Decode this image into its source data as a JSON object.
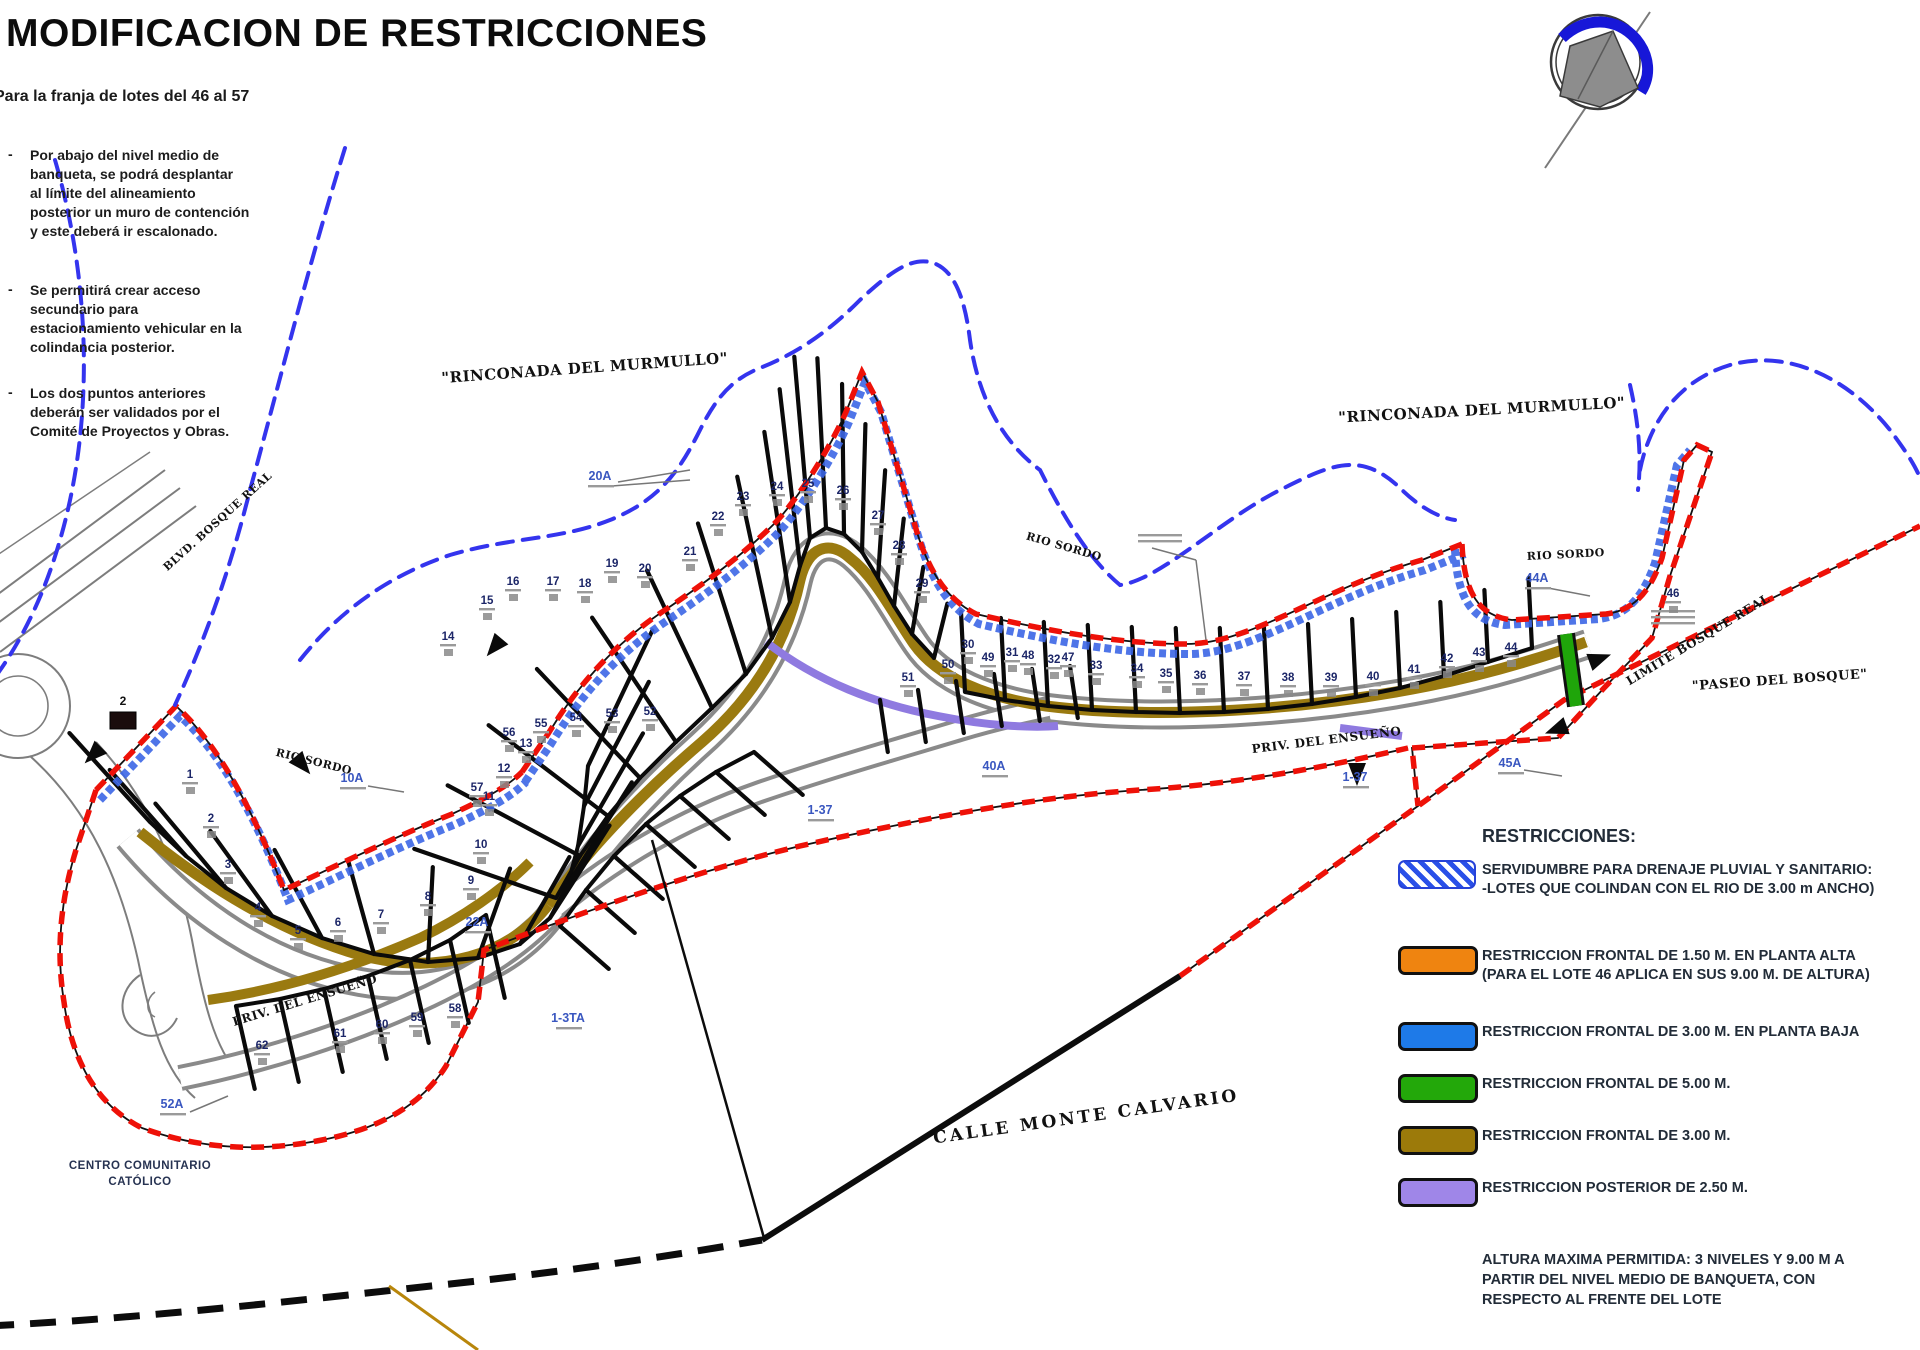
{
  "title": "MODIFICACION DE RESTRICCIONES",
  "subtitle": "Para la franja de lotes del 46 al 57",
  "bullets": [
    {
      "text": "Por abajo del nivel medio de\nbanqueta, se podrá desplantar\nal límite del alineamiento\nposterior un muro de contención\ny este deberá ir escalonado."
    },
    {
      "text": "Se permitirá crear acceso\nsecundario para\nestacionamiento vehicular en la\ncolindancia posterior."
    },
    {
      "text": "Los dos puntos anteriores\ndeberán ser validados por el\nComité de Proyectos y Obras."
    }
  ],
  "legend": {
    "heading": "RESTRICCIONES:",
    "items": [
      {
        "swatch": "hatch-blue",
        "color": "#2a50e8",
        "text": "SERVIDUMBRE PARA DRENAJE PLUVIAL Y SANITARIO:\n-LOTES QUE COLINDAN CON EL RIO DE 3.00 m ANCHO)"
      },
      {
        "swatch": "orange",
        "color": "#ef8410",
        "text": "RESTRICCION FRONTAL DE 1.50 M. EN PLANTA ALTA\n(PARA EL LOTE 46 APLICA EN SUS 9.00 M. DE ALTURA)"
      },
      {
        "swatch": "blue",
        "color": "#1e7ae8",
        "text": "RESTRICCION FRONTAL DE 3.00 M. EN PLANTA BAJA"
      },
      {
        "swatch": "green",
        "color": "#23a80a",
        "text": "RESTRICCION FRONTAL DE 5.00 M."
      },
      {
        "swatch": "olive",
        "color": "#9c7a0a",
        "text": "RESTRICCION FRONTAL DE 3.00 M."
      },
      {
        "swatch": "purple",
        "color": "#9f86e8",
        "text": "RESTRICCION POSTERIOR DE 2.50 M."
      }
    ],
    "note": "ALTURA MAXIMA PERMITIDA: 3 NIVELES Y 9.00 M A\nPARTIR DEL NIVEL MEDIO DE BANQUETA, CON\nRESPECTO AL FRENTE DEL LOTE"
  },
  "footer": {
    "centro": "CENTRO COMUNITARIO\nCATÓLICO"
  },
  "map": {
    "colors": {
      "boundary_red": "#ee1108",
      "easement_blue": "#3b66e6",
      "boundary_dashed_blue": "#3434ee",
      "frontal_olive": "#9a7a10",
      "frontal_green": "#1fa50a",
      "posterior_purple": "#8f7ae0",
      "north_arrow_blue": "#1717d8"
    },
    "north_arrow": {
      "name": "compass-north-arrow"
    },
    "street_labels": [
      {
        "text": "\"RINCONADA DEL MURMULLO\"",
        "x": 585,
        "y": 373,
        "rot": -4,
        "size": 15
      },
      {
        "text": "\"RINCONADA DEL MURMULLO\"",
        "x": 1482,
        "y": 415,
        "rot": -3,
        "size": 15
      },
      {
        "text": "RIO SORDO",
        "x": 313,
        "y": 765,
        "rot": 14,
        "size": 11
      },
      {
        "text": "RIO SORDO",
        "x": 1063,
        "y": 550,
        "rot": 16,
        "size": 11
      },
      {
        "text": "RIO SORDO",
        "x": 1566,
        "y": 558,
        "rot": -3,
        "size": 11
      },
      {
        "text": "CALLE MONTE CALVARIO",
        "x": 1087,
        "y": 1122,
        "rot": -8,
        "size": 17
      },
      {
        "text": "PRIV. DEL ENSUEÑO",
        "x": 1327,
        "y": 744,
        "rot": -7,
        "size": 12
      },
      {
        "text": "PRIV. DEL ENSUEÑO",
        "x": 306,
        "y": 1004,
        "rot": -17,
        "size": 12
      },
      {
        "text": "LIMITE BOSQUE REAL",
        "x": 1700,
        "y": 643,
        "rot": -31,
        "size": 12
      },
      {
        "text": "\"PASEO DEL BOSQUE\"",
        "x": 1780,
        "y": 684,
        "rot": -4,
        "size": 13
      },
      {
        "text": "BLVD. BOSQUE REAL",
        "x": 220,
        "y": 524,
        "rot": -42,
        "size": 11
      }
    ],
    "special_labels": [
      {
        "text": "20A",
        "x": 600,
        "y": 480
      },
      {
        "text": "10A",
        "x": 352,
        "y": 782
      },
      {
        "text": "22A",
        "x": 477,
        "y": 926
      },
      {
        "text": "40A",
        "x": 994,
        "y": 770
      },
      {
        "text": "44A",
        "x": 1537,
        "y": 582
      },
      {
        "text": "45A",
        "x": 1510,
        "y": 767
      },
      {
        "text": "52A",
        "x": 172,
        "y": 1108
      },
      {
        "text": "1-37",
        "x": 1355,
        "y": 781
      },
      {
        "text": "1-37",
        "x": 820,
        "y": 814
      },
      {
        "text": "1-3TA",
        "x": 568,
        "y": 1022
      }
    ],
    "boxed_label": {
      "text": "2",
      "x": 124,
      "y": 706
    },
    "lot_numbers": [
      {
        "n": "1",
        "x": 190,
        "y": 778
      },
      {
        "n": "2",
        "x": 211,
        "y": 822
      },
      {
        "n": "3",
        "x": 228,
        "y": 868
      },
      {
        "n": "4",
        "x": 258,
        "y": 911
      },
      {
        "n": "5",
        "x": 298,
        "y": 934
      },
      {
        "n": "6",
        "x": 338,
        "y": 926
      },
      {
        "n": "7",
        "x": 381,
        "y": 918
      },
      {
        "n": "8",
        "x": 428,
        "y": 900
      },
      {
        "n": "9",
        "x": 471,
        "y": 884
      },
      {
        "n": "10",
        "x": 481,
        "y": 848
      },
      {
        "n": "11",
        "x": 489,
        "y": 800
      },
      {
        "n": "12",
        "x": 504,
        "y": 772
      },
      {
        "n": "13",
        "x": 526,
        "y": 747
      },
      {
        "n": "14",
        "x": 448,
        "y": 640
      },
      {
        "n": "15",
        "x": 487,
        "y": 604
      },
      {
        "n": "16",
        "x": 513,
        "y": 585
      },
      {
        "n": "17",
        "x": 553,
        "y": 585
      },
      {
        "n": "18",
        "x": 585,
        "y": 587
      },
      {
        "n": "19",
        "x": 612,
        "y": 567
      },
      {
        "n": "20",
        "x": 645,
        "y": 572
      },
      {
        "n": "21",
        "x": 690,
        "y": 555
      },
      {
        "n": "22",
        "x": 718,
        "y": 520
      },
      {
        "n": "23",
        "x": 743,
        "y": 500
      },
      {
        "n": "24",
        "x": 777,
        "y": 490
      },
      {
        "n": "25",
        "x": 808,
        "y": 487
      },
      {
        "n": "26",
        "x": 843,
        "y": 494
      },
      {
        "n": "27",
        "x": 878,
        "y": 519
      },
      {
        "n": "28",
        "x": 899,
        "y": 549
      },
      {
        "n": "29",
        "x": 922,
        "y": 587
      },
      {
        "n": "30",
        "x": 968,
        "y": 648
      },
      {
        "n": "31",
        "x": 1012,
        "y": 656
      },
      {
        "n": "32",
        "x": 1054,
        "y": 663
      },
      {
        "n": "33",
        "x": 1096,
        "y": 669
      },
      {
        "n": "34",
        "x": 1137,
        "y": 672
      },
      {
        "n": "35",
        "x": 1166,
        "y": 677
      },
      {
        "n": "36",
        "x": 1200,
        "y": 679
      },
      {
        "n": "37",
        "x": 1244,
        "y": 680
      },
      {
        "n": "38",
        "x": 1288,
        "y": 681
      },
      {
        "n": "39",
        "x": 1331,
        "y": 681
      },
      {
        "n": "40",
        "x": 1373,
        "y": 680
      },
      {
        "n": "41",
        "x": 1414,
        "y": 673
      },
      {
        "n": "42",
        "x": 1447,
        "y": 662
      },
      {
        "n": "43",
        "x": 1479,
        "y": 656
      },
      {
        "n": "44",
        "x": 1511,
        "y": 651
      },
      {
        "n": "46",
        "x": 1673,
        "y": 597
      },
      {
        "n": "47",
        "x": 1068,
        "y": 661
      },
      {
        "n": "48",
        "x": 1028,
        "y": 659
      },
      {
        "n": "49",
        "x": 988,
        "y": 661
      },
      {
        "n": "50",
        "x": 948,
        "y": 668
      },
      {
        "n": "51",
        "x": 908,
        "y": 681
      },
      {
        "n": "52",
        "x": 650,
        "y": 715
      },
      {
        "n": "53",
        "x": 612,
        "y": 717
      },
      {
        "n": "54",
        "x": 576,
        "y": 721
      },
      {
        "n": "55",
        "x": 541,
        "y": 727
      },
      {
        "n": "56",
        "x": 509,
        "y": 736
      },
      {
        "n": "57",
        "x": 477,
        "y": 791
      },
      {
        "n": "58",
        "x": 455,
        "y": 1012
      },
      {
        "n": "59",
        "x": 417,
        "y": 1021
      },
      {
        "n": "60",
        "x": 382,
        "y": 1028
      },
      {
        "n": "61",
        "x": 340,
        "y": 1037
      },
      {
        "n": "62",
        "x": 262,
        "y": 1049
      }
    ]
  }
}
